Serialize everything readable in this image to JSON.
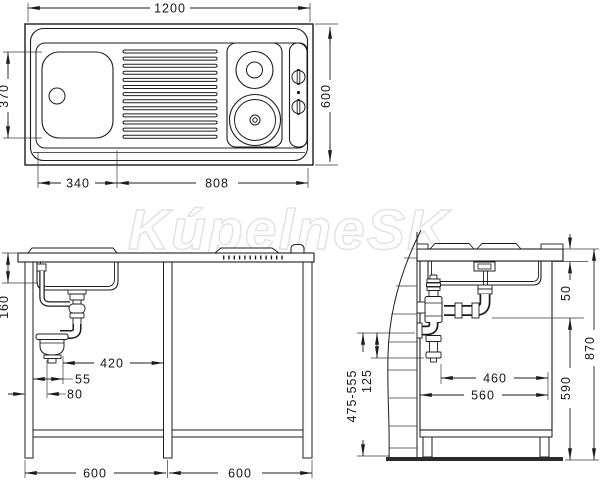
{
  "watermark": "KúpelneSK",
  "colors": {
    "line": "#1c1c1c",
    "watermark": "#e3e3e3",
    "floor": "#2b2b2b"
  },
  "top_view": {
    "overall_width": "1200",
    "overall_depth": "600",
    "bowl_depth": "370",
    "bowl_width": "340",
    "hob_section_width": "808"
  },
  "front_view": {
    "bowl_height": "160",
    "trap_to_divider": "420",
    "trap_side_offset": "55",
    "trap_front_offset": "80",
    "left_module_width": "600",
    "right_module_width": "600"
  },
  "side_view": {
    "worktop_edge_height": "50",
    "total_height": "870",
    "drain_pipe_height": "590",
    "outlet_to_front": "460",
    "cabinet_depth": "560",
    "outlet_height_range": "475-555",
    "outlet_drop": "125"
  }
}
